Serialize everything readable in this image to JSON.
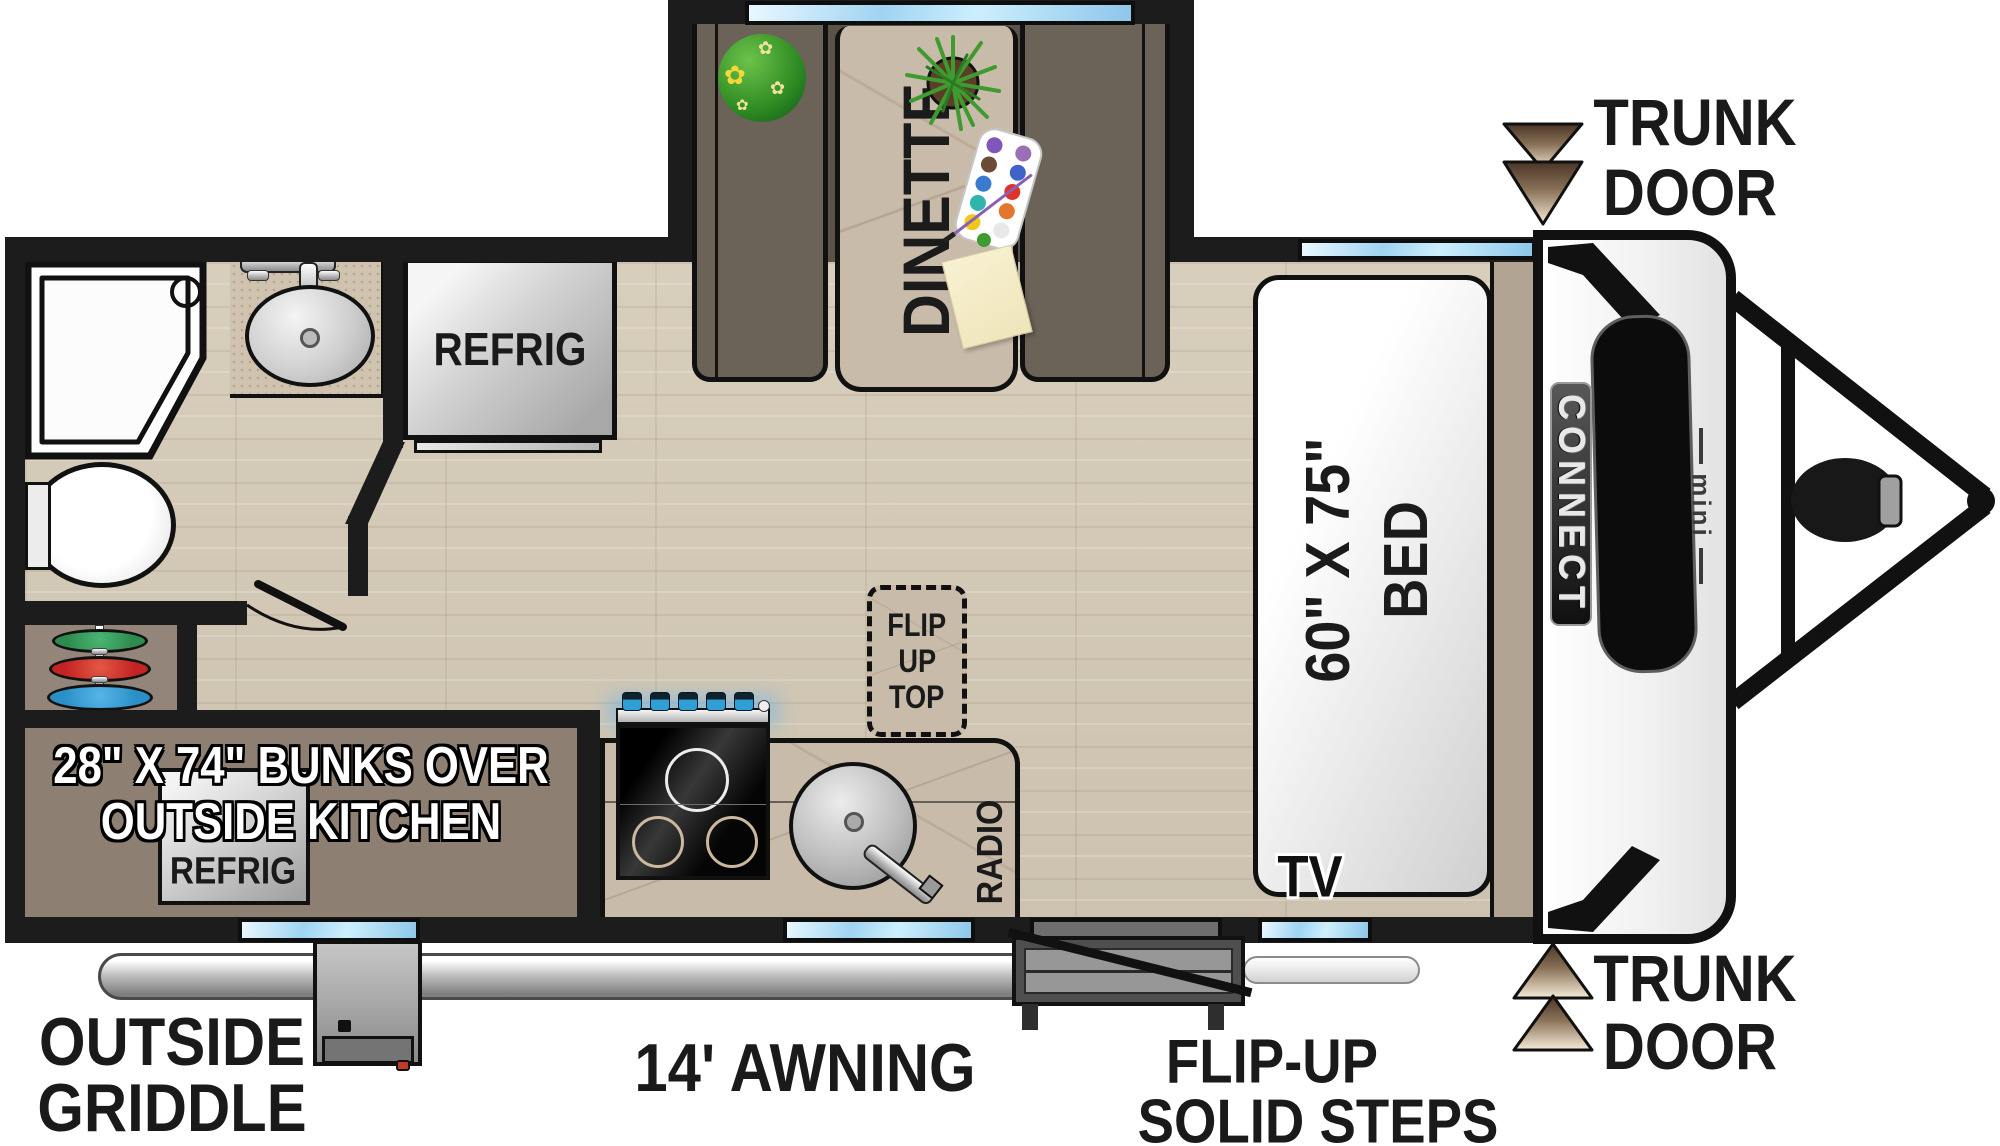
{
  "branding": {
    "model": "CONNECT",
    "trim": "mini"
  },
  "rooms": {
    "dinette": "DINETTE",
    "refrig": "REFRIG",
    "bed": {
      "line1": "60\" X 75\"",
      "line2": "BED"
    },
    "tv": "TV",
    "radio": "RADIO",
    "flip_up_top": {
      "line1": "FLIP",
      "line2": "UP",
      "line3": "TOP"
    },
    "bunks": {
      "line1": "28\" X 74\" BUNKS OVER",
      "line2": "OUTSIDE KITCHEN",
      "refrig": "REFRIG"
    }
  },
  "labels": {
    "trunk_door_top": {
      "line1": "TRUNK",
      "line2": "DOOR"
    },
    "trunk_door_bottom": {
      "line1": "TRUNK",
      "line2": "DOOR"
    },
    "outside_griddle": {
      "line1": "OUTSIDE",
      "line2": "GRIDDLE"
    },
    "awning": "14' AWNING",
    "flip_up_steps": {
      "line1": "FLIP-UP",
      "line2": "SOLID STEPS"
    }
  },
  "colors": {
    "wall": "#1c1c1c",
    "floor": "#d3c9b7",
    "slideFloor": "#5b5348",
    "counter": "#c9bbaa",
    "seat": "#6b6357",
    "bunk": "#8d8073",
    "cabinet": "#93857a",
    "window1": "#eaf8ff",
    "window2": "#9fd4f2",
    "mattress": "#f2f2f2",
    "platform": "#b2a493",
    "ink": "#1a1a1a",
    "arrowDark": "#4a3526",
    "arrowLight": "#f7ecd9",
    "plateGreen": "#2e8b4f",
    "plateRed": "#c42323",
    "plateBlue": "#2a8fc7",
    "ballGreen": "#2e8b22",
    "plantGreen": "#3f9b2f",
    "knobBlue": "#2f9fd6"
  }
}
